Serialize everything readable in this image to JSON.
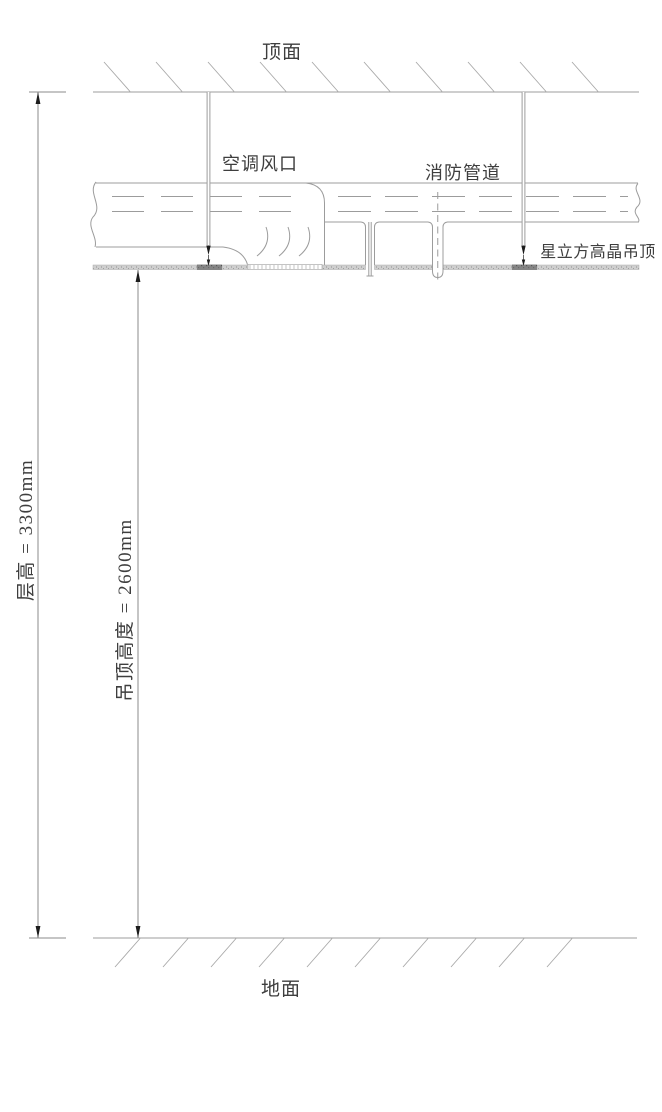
{
  "labels": {
    "top_surface": "顶面",
    "ac_vent": "空调风口",
    "fire_pipe": "消防管道",
    "ceiling_product": "星立方高晶吊顶",
    "floor": "地面"
  },
  "dimensions": {
    "floor_height_label": "层高 = 3300mm",
    "floor_height_mm": "3300",
    "ceiling_height_label": "吊顶高度 = 2600mm",
    "ceiling_height_mm": "2600"
  },
  "colors": {
    "background": "#ffffff",
    "drawing_line": "#9c9c9c",
    "dimension_line": "#8b8b8b",
    "text": "#3e3e3e",
    "arrow": "#1c1c1c",
    "ceiling_band_fill": "#cfcfcf",
    "ceiling_clamp_fill": "#858585"
  }
}
